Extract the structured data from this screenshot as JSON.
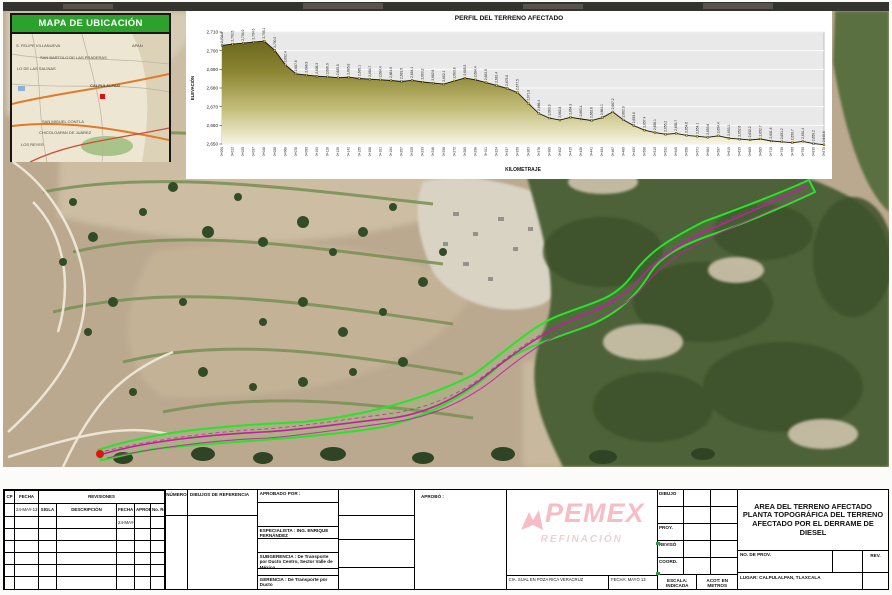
{
  "inset": {
    "title": "MAPA DE UBICACIÓN",
    "labels": [
      "S. FELIPE VILLANUEVA",
      "APAN",
      "SAN BARTOLO DE LAS PRADERAS",
      "LO DE LAS SALINAS",
      "CALPULALPAN",
      "SAN MIGUEL CONTLA",
      "CHICOLOAPAN DE JUÁREZ",
      "LOS REYES"
    ]
  },
  "chart_data": {
    "type": "area",
    "title": "PERFIL DEL TERRENO AFECTADO",
    "xlabel": "KILOMETRAJE",
    "ylabel": "ELEVACIÓN",
    "ylim": [
      2650,
      2710
    ],
    "ytick_step": 10,
    "grid": "horizontal-white-on-gray",
    "plot_bg": "#e9e9e9",
    "line_color": "#16160a",
    "fill_top": "#6b671c",
    "fill_bottom": "#f8f5e3",
    "x": [
      "0+000",
      "0+012",
      "0+025",
      "0+037",
      "0+048",
      "0+058",
      "0+068",
      "0+078",
      "0+090",
      "0+103",
      "0+116",
      "0+129",
      "0+142",
      "0+155",
      "0+168",
      "0+181",
      "0+194",
      "0+207",
      "0+220",
      "0+233",
      "0+246",
      "0+259",
      "0+272",
      "0+285",
      "0+298",
      "0+311",
      "0+324",
      "0+337",
      "0+350",
      "0+363",
      "0+376",
      "0+389",
      "0+402",
      "0+415",
      "0+428",
      "0+441",
      "0+454",
      "0+467",
      "0+480",
      "0+493",
      "0+506",
      "0+519",
      "0+532",
      "0+545",
      "0+558",
      "0+571",
      "0+584",
      "0+597",
      "0+610",
      "0+635",
      "0+660",
      "0+685",
      "0+710",
      "0+735",
      "0+760",
      "0+790",
      "0+830",
      "0+875"
    ],
    "y": [
      2702.8,
      2703.5,
      2704.0,
      2704.6,
      2705.1,
      2700.2,
      2692.4,
      2687.6,
      2686.9,
      2686.3,
      2686.0,
      2685.5,
      2685.8,
      2685.1,
      2684.7,
      2684.4,
      2684.0,
      2683.5,
      2684.1,
      2683.2,
      2682.6,
      2682.1,
      2683.8,
      2685.3,
      2684.4,
      2682.9,
      2681.4,
      2679.8,
      2677.5,
      2671.8,
      2666.4,
      2663.9,
      2662.8,
      2664.3,
      2663.4,
      2662.6,
      2664.1,
      2667.2,
      2662.9,
      2659.8,
      2657.4,
      2656.1,
      2655.2,
      2655.7,
      2654.6,
      2654.1,
      2653.6,
      2654.4,
      2653.1,
      2652.6,
      2652.2,
      2652.7,
      2651.6,
      2651.2,
      2650.7,
      2651.4,
      2650.2,
      2649.6
    ]
  },
  "photo": {
    "corridor_color": "#2ae22a",
    "trace_color": "#c11fa0",
    "origin_marker_color": "#e31212"
  },
  "titleblock": {
    "rev_table": {
      "headers": {
        "cp": "CP",
        "fecha": "FECHA",
        "revisiones": "REVISIONES",
        "numero": "NÚMERO",
        "dibujos": "DIBUJOS DE REFERENCIA",
        "aprobado_por": "APROBADO POR :",
        "aprobo": "APROBÓ :"
      },
      "subheaders": {
        "sigla": "SIGLA",
        "descripcion": "DESCRIPCIÓN",
        "fecha": "FECHA",
        "aprobo": "APROBÓ",
        "no_re": "No. Re."
      },
      "date1": "24-MAY-13",
      "date2": "24-MAY-13",
      "especialista": "ESPECIALISTA : ING. ENRIQUE FERNÁNDEZ",
      "subgerencia": "SUBGERENCIA : De Transporte por Ducto Centro, Sector Valle de México.",
      "gerencia": "GERENCIA : De Transporte por Ducto"
    },
    "pemex": {
      "brand": "PEMEX",
      "division": "REFINACIÓN",
      "office": "CIA. SUAL EN POZA RICA VERACRUZ",
      "fecha": "FECHA: MAYO 13"
    },
    "sign_labels": {
      "dibujo": "DIBUJO",
      "proy": "PROY.",
      "reviso": "REVISÓ",
      "coord": "COORD.",
      "escala": "ESCALA: INDICADA",
      "acot": "ACOT: EN METROS"
    },
    "title_box": {
      "lines": [
        "AREA DEL TERRENO AFECTADO",
        "PLANTA TOPOGRÁFICA DEL TERRENO",
        "AFECTADO POR EL DERRAME DE DIESEL"
      ],
      "no_de_prov": "NO. DE PROV.",
      "rev": "REV.",
      "lugar": "LUGAR: CALPULALPAN, TLAXCALA"
    }
  }
}
